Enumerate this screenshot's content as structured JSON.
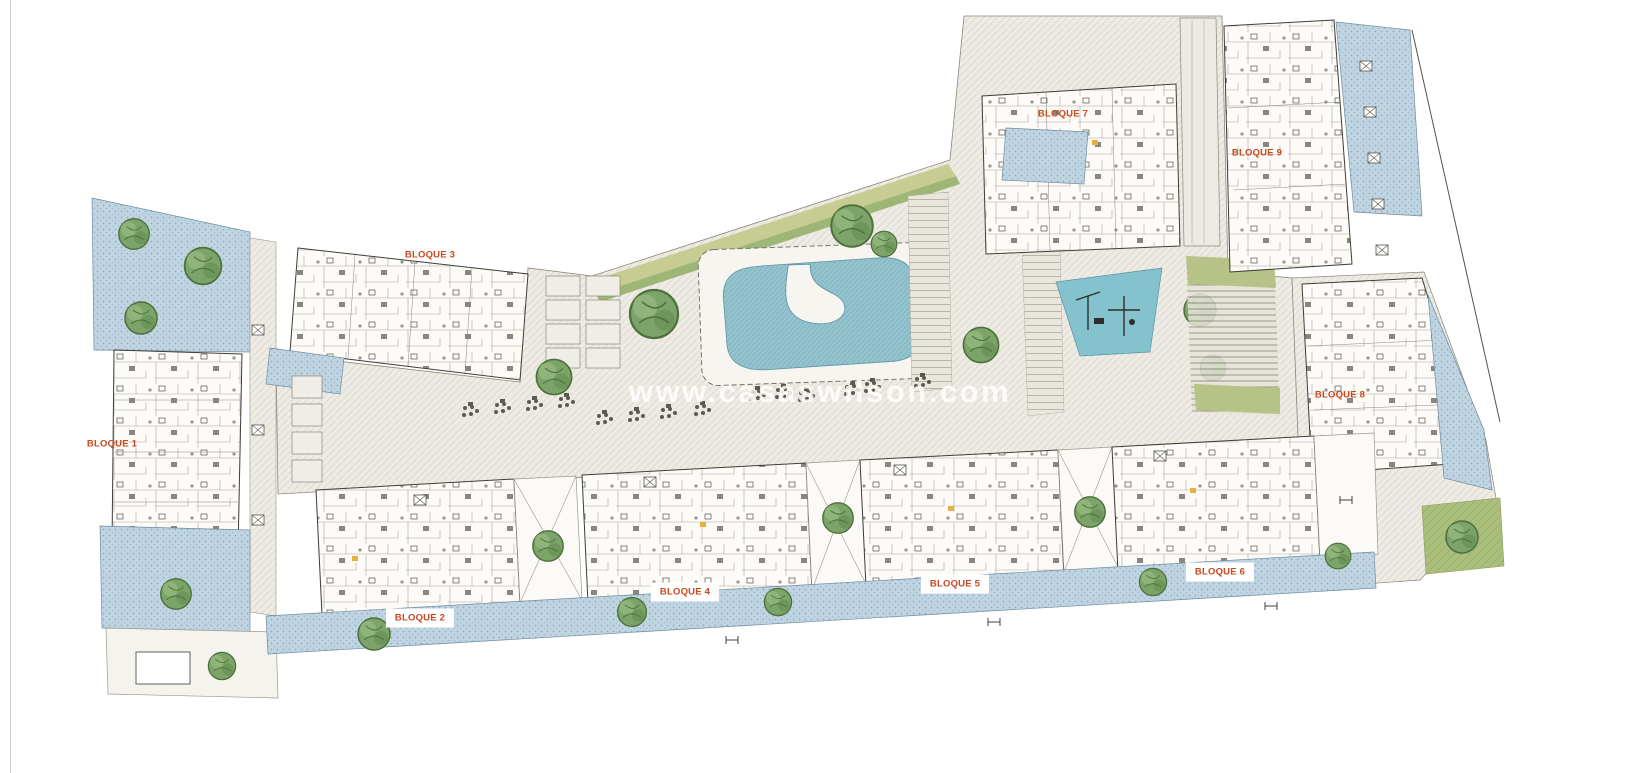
{
  "plan": {
    "watermark": "www.casaswilson.com",
    "blocks": [
      {
        "label": "BLOQUE 1"
      },
      {
        "label": "BLOQUE 2"
      },
      {
        "label": "BLOQUE 3"
      },
      {
        "label": "BLOQUE 4"
      },
      {
        "label": "BLOQUE 5"
      },
      {
        "label": "BLOQUE 6"
      },
      {
        "label": "BLOQUE 7"
      },
      {
        "label": "BLOQUE 8"
      },
      {
        "label": "BLOQUE 9"
      }
    ]
  },
  "palette": {
    "background": "#ffffff",
    "paving": "#edebe4",
    "paving_hatch": "#dcd8ce",
    "terrace_blue": "#c1d4e2",
    "terrace_dot": "#8aadc6",
    "pool_water": "#95c3ce",
    "pool_hatch": "#7cb2c0",
    "playground_blue": "#84c2ce",
    "tree_green": "#7da468",
    "tree_dark": "#4e6f3c",
    "lawn_green": "#abbf7d",
    "hedge_olive": "#c6cc92",
    "hedge_green": "#8fae63",
    "building_fill": "#fcfbf8",
    "outline_dark": "#3f3d37",
    "label_orange": "#c8471d",
    "door_yellow": "#e7b23c"
  },
  "icons": {
    "tree-icon": "green canopy blob",
    "ac-unit-icon": "small crossed square",
    "furniture-cluster-icon": "cluster of dark dots",
    "section-mark-icon": "double-T survey mark"
  }
}
